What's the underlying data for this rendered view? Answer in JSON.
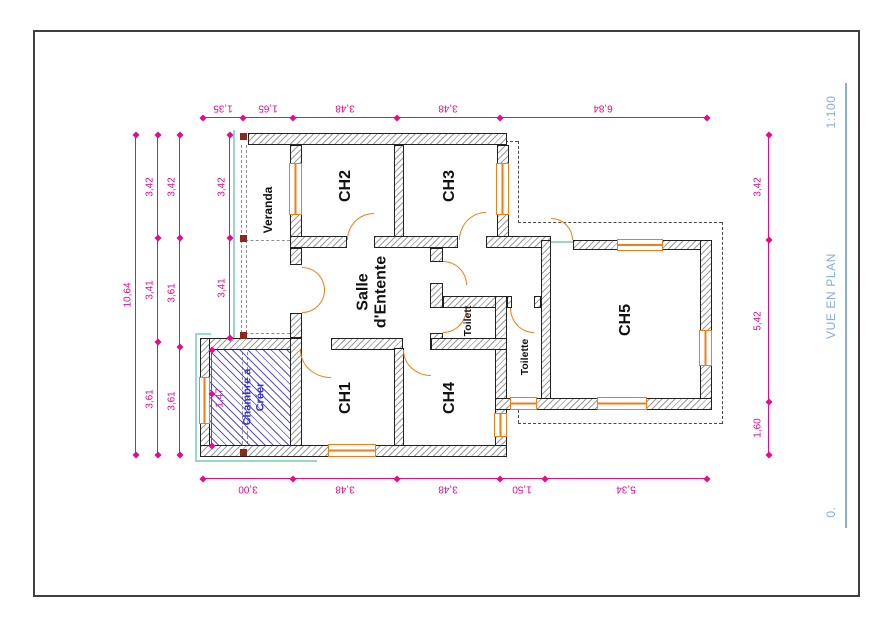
{
  "sheet": {
    "scale": "1:100",
    "view_title": "VUE EN PLAN",
    "level": "0."
  },
  "rooms": {
    "veranda": "Veranda",
    "ch1": "CH1",
    "ch2": "CH2",
    "ch3": "CH3",
    "ch4": "CH4",
    "ch5": "CH5",
    "salle_1": "Salle",
    "salle_2": "d'Entente",
    "wc_small": "Toilett",
    "wc_large": "Toilette",
    "chambre_1": "Chambre a",
    "chambre_2": "Créer"
  },
  "dims": {
    "top": [
      "1,35",
      "1,65",
      "3,48",
      "3,48",
      "6,84"
    ],
    "bottom": [
      "3,00",
      "3,48",
      "3,48",
      "1,50",
      "5,34"
    ],
    "left_total": "10,64",
    "left_a": [
      "3,42",
      "3,41",
      "3,61"
    ],
    "left_b": [
      "3,42",
      "3,61",
      "3,61"
    ],
    "left_inner": [
      "3,42",
      "3,41"
    ],
    "right": [
      "3,42",
      "5,42",
      "1,60"
    ],
    "chambre": "1,47"
  },
  "colors": {
    "dimension": "#e8098c",
    "openings": "#ef7e19",
    "proposed_room": "#3535cf",
    "annotation": "#86aede",
    "outline": "#96d9c6"
  }
}
